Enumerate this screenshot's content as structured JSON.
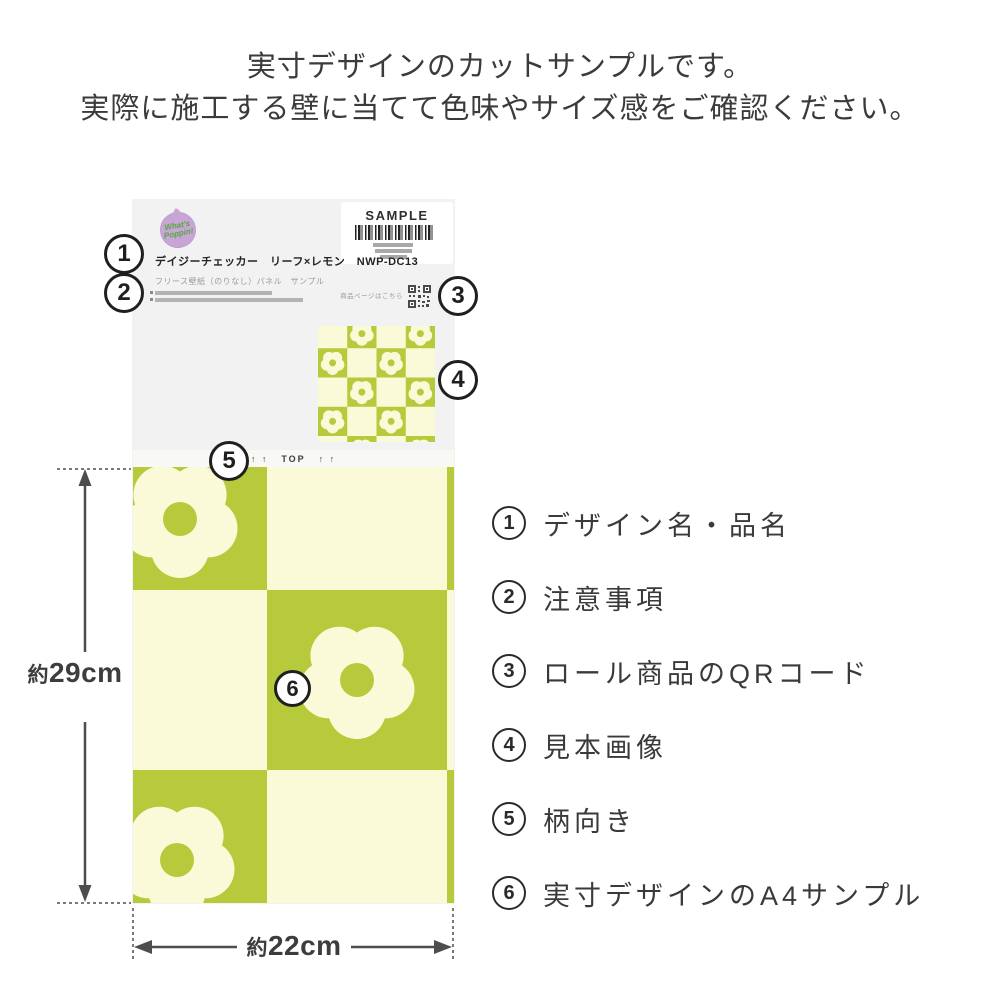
{
  "header": {
    "line1": "実寸デザインのカットサンプルです。",
    "line2": "実際に施工する壁に当てて色味やサイズ感をご確認ください。"
  },
  "sample_card": {
    "logo_line1": "What's",
    "logo_line2": "Poppin!",
    "sample_label": "SAMPLE",
    "product_name": "デイジーチェッカー　リーフ×レモン　NWP-DC13",
    "product_subtitle": "フリース壁紙（のりなし）パネル　サンプル",
    "qr_caption": "商品ページはこちら",
    "top_arrows_left": "↑ ↑",
    "top_label": "TOP",
    "top_arrows_right": "↑ ↑"
  },
  "dimensions": {
    "height_label": "約29cm",
    "width_label": "約22cm"
  },
  "callouts": [
    "1",
    "2",
    "3",
    "4",
    "5",
    "6"
  ],
  "legend": [
    {
      "num": "1",
      "label": "デザイン名・品名"
    },
    {
      "num": "2",
      "label": "注意事項"
    },
    {
      "num": "3",
      "label": "ロール商品のQRコード"
    },
    {
      "num": "4",
      "label": "見本画像"
    },
    {
      "num": "5",
      "label": "柄向き"
    },
    {
      "num": "6",
      "label": "実寸デザインのA4サンプル"
    }
  ],
  "colors": {
    "pattern_green": "#b6ca3c",
    "pattern_cream": "#fbfad8",
    "paper_gray": "#f2f2f2",
    "logo_purple": "#c7a6d6",
    "logo_green": "#55a63c",
    "ink": "#3a3a3a"
  }
}
